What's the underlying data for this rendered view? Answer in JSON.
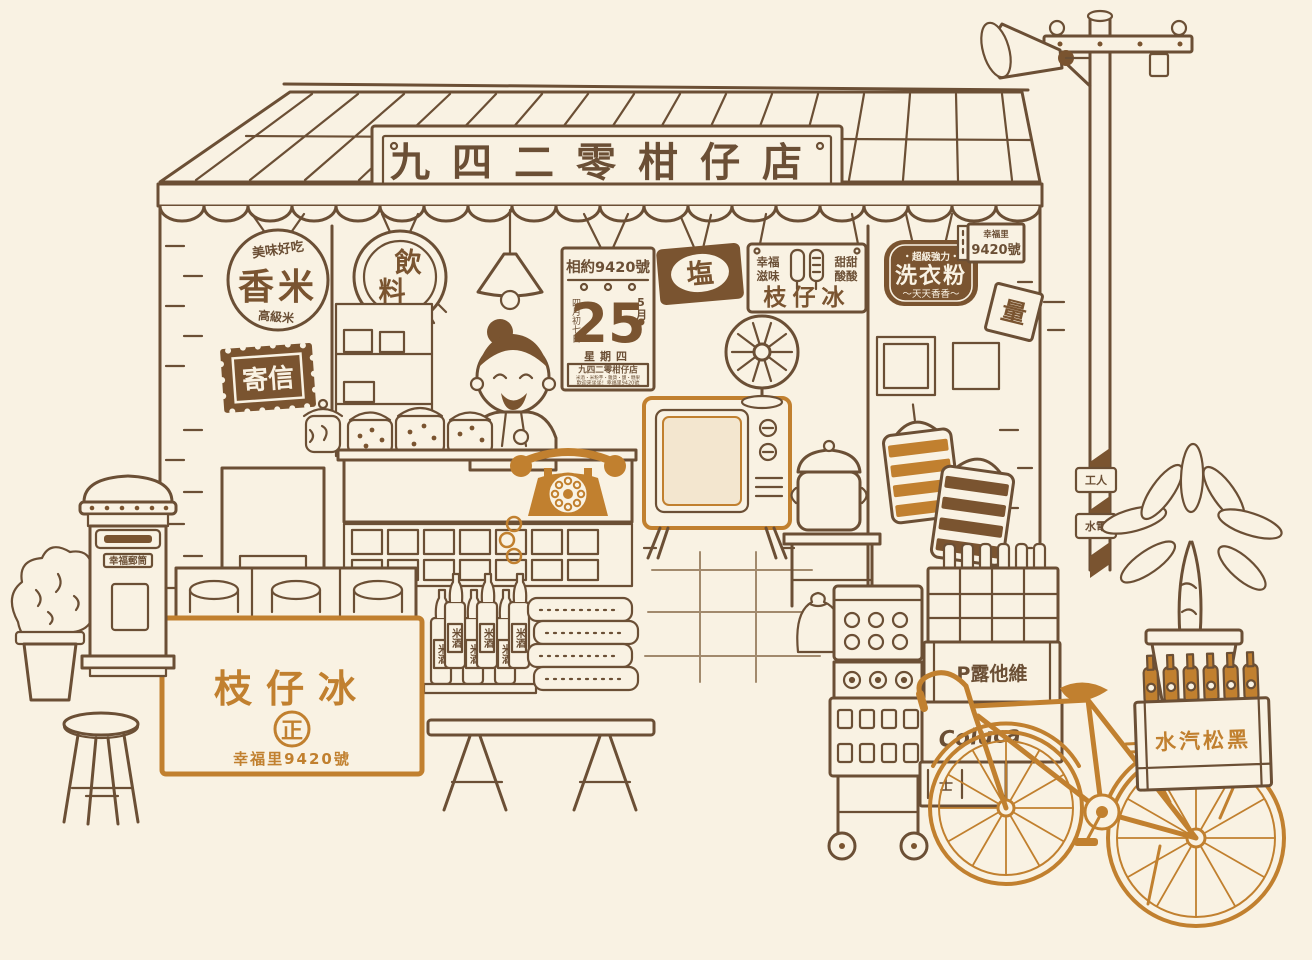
{
  "colors": {
    "background": "#f9f2e3",
    "ink": "#6b4f35",
    "accent": "#c1802f",
    "dark_sign": "#7a5430"
  },
  "signs": {
    "main": "九四二零柑仔店",
    "rice": {
      "top": "美味好吃",
      "title": "香米",
      "bottom": "高級米"
    },
    "drink": {
      "char1": "飲",
      "char2": "料"
    },
    "salt": "塩",
    "popsicle": {
      "left1": "幸福",
      "left2": "滋味",
      "right1": "甜甜",
      "right2": "酸酸",
      "title": "枝仔冰"
    },
    "detergent": {
      "top": "・超級強力・",
      "title": "洗衣粉",
      "bottom": "～天天香香～"
    },
    "mail": "寄信",
    "diamond": "量",
    "address": {
      "district": "幸福里",
      "number": "9420號"
    }
  },
  "calendar": {
    "header": "相約9420號",
    "lunar": "四月初七日",
    "month": "5月",
    "date": "25",
    "weekday": "星期四",
    "shop": "九四二零柑仔店",
    "goods": "米酒・米粉芋・雜貨・鹽・糖果",
    "welcome": "歡迎來坐坐！幸福里9420號"
  },
  "freezer": {
    "title": "枝仔冰",
    "seal": "正",
    "address": "幸福里9420號"
  },
  "shelf": {
    "bottle": "米酒"
  },
  "street": {
    "postbox": "幸福郵筒",
    "pole_top": "工人",
    "pole_bottom": "水電"
  },
  "crates": {
    "top": "P露他維",
    "middle": "Coluca",
    "small": "士",
    "bike": "水汽松黑"
  }
}
